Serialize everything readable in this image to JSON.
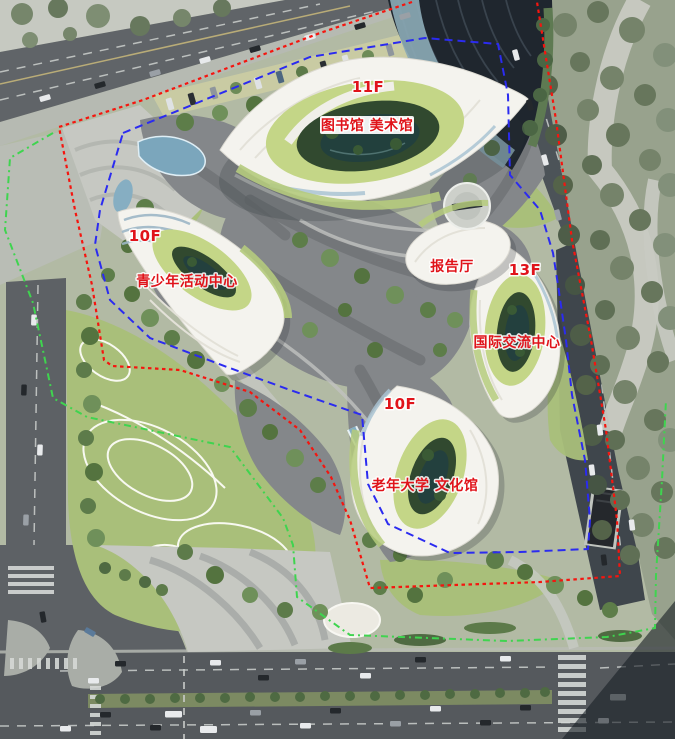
{
  "colors": {
    "label_red": "#e0131a",
    "boundary_red": "#f5150f",
    "boundary_blue": "#2b2bf0",
    "boundary_green": "#3fd44f",
    "building_shell": "#f4f3ee",
    "grass_ring": "#c4d687",
    "courtyard_green": "#31492f",
    "lawn_green": "#a9bf7a",
    "plaza_gray": "#85888a",
    "road_gray": "#5d6165",
    "water_blue": "#7ba6bc",
    "park_green": "#98a28d"
  },
  "buildings": [
    {
      "id": "library",
      "floors": "11F",
      "name": "图书馆 美术馆"
    },
    {
      "id": "youth-center",
      "floors": "10F",
      "name": "青少年活动中心"
    },
    {
      "id": "lecture-hall",
      "floors": "",
      "name": "报告厅"
    },
    {
      "id": "exchange-center",
      "floors": "13F",
      "name": "国际交流中心"
    },
    {
      "id": "culture-hall",
      "floors": "10F",
      "name": "老年大学 文化馆"
    }
  ]
}
